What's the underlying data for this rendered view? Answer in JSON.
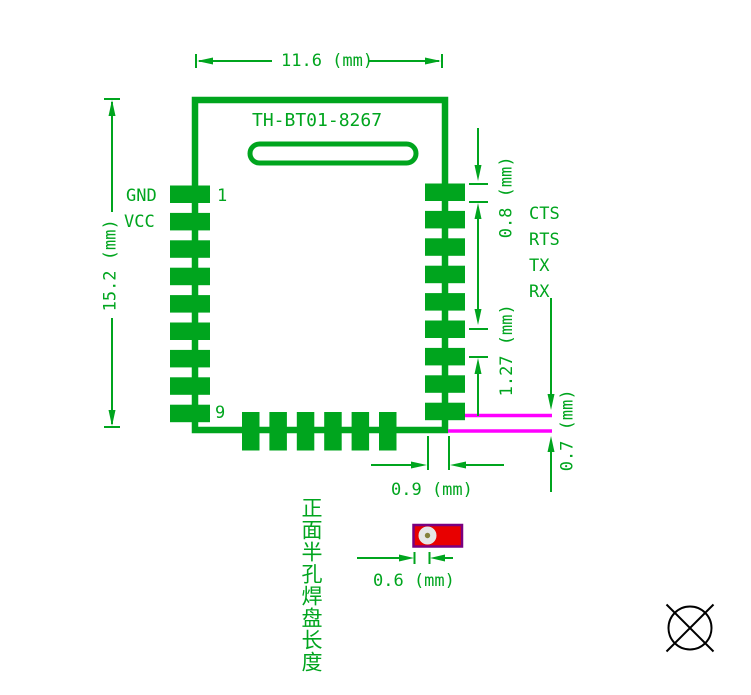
{
  "module": {
    "title": "TH-BT01-8267",
    "pin_first": "1",
    "pin_ninth": "9",
    "left_pin_labels": [
      "GND",
      "VCC"
    ],
    "right_pin_labels": [
      "CTS",
      "RTS",
      "TX",
      "RX"
    ]
  },
  "dimensions": {
    "module_width": "11.6 (mm)",
    "module_height": "15.2 (mm)",
    "pad_width": "0.8 (mm)",
    "pad_pitch": "1.27 (mm)",
    "edge_offset": "0.7 (mm)",
    "pad_length": "0.9 (mm)",
    "half_hole_diameter": "0.6 (mm)"
  },
  "annotation": {
    "half_hole_note": "正面半孔焊盘长度"
  },
  "colors": {
    "trace_green": "#00a51e",
    "highlight_magenta": "#ff00ff",
    "pad_red": "#e80000",
    "pad_border_purple": "#7a0080",
    "symbol_black": "#000000"
  }
}
